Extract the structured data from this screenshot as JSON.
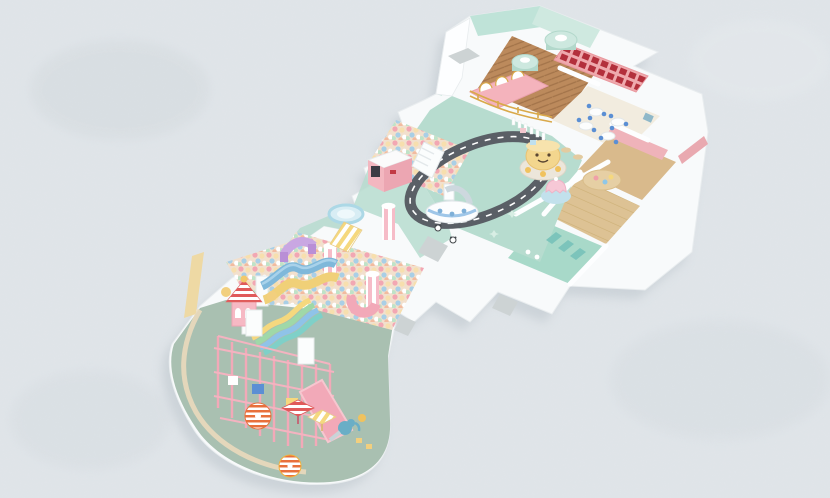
{
  "scene": {
    "subject": "isometric 3D render of a pastel children's indoor playground floor plan",
    "visible_text": ""
  },
  "palette": {
    "background": "#e0e5e9",
    "backgroundSpot": "#d5dbdf",
    "buildingShadow": "#b9c2c9",
    "wallWhite": "#f8fafb",
    "wallFace": "#fdfeff",
    "wallMint": "#bfe3d8",
    "wallMintLight": "#cfe9e0",
    "wallPink": "#efb3ba",
    "wallPinkDeep": "#e9a9b0",
    "wallCream": "#ead9bd",
    "wallYellow": "#eed9a4",
    "floorEntranceWood": "#bc8a5c",
    "floorParty": "#f2ecdf",
    "floorRoomWood": "#d9ba8c",
    "floorSlatWood": "#ddc294",
    "floorToilet": "#a8d9c9",
    "floorMint": "#b7dccf",
    "floorSage": "#a9c0b1",
    "ballPitBase": "#f2e0cd",
    "roadAsphalt": "#5a5f66",
    "roadLine": "#ffffff",
    "shelfPink": "#efa9ad",
    "shelfRed": "#b3303c",
    "counterPink": "#f4b3bc",
    "goldTrim": "#d9a94a",
    "tableMint": "#cde8df",
    "tableMintSide": "#b2d8cb",
    "chairBlue": "#5b8fd4",
    "tableWhite": "#fcfdfd",
    "stallTeal": "#7cc4bb",
    "carouselYellow": "#f3d68e",
    "carouselScallop": "#f7e3ad",
    "jellyfishPink": "#f6c8d6",
    "jellyfishMat": "#c2e1ec",
    "platformWood": "#e6cfa4",
    "houseFront": "#f3b7c0",
    "houseWindow": "#3c3c44",
    "boatWhite": "#fcfdfe",
    "boatBlue": "#9fc6e8",
    "trampolineBlue": "#d8edf4",
    "trampolineRing": "#acd8e6",
    "slideWaveBlue": "#7fb8da",
    "slideWaveYellow": "#f0d078",
    "tubePink": "#f2a9b8",
    "archPurple": "#c9a7e2",
    "towerPink": "#f6b9c4",
    "roofBandRed": "#e05a5a",
    "rainbowYellow": "#f5d87e",
    "rainbowGreen": "#9fd8a8",
    "rainbowBlue": "#8fc3e8",
    "rainbowTeal": "#7fd0c8",
    "structurePink": "#f2a9b8",
    "structurePinkLight": "#f7c6cf",
    "umbrellaOrange": "#e8703c",
    "umbrellaYellow": "#f2b13c",
    "elephantTeal": "#6aaec6",
    "matGray": "#cdd3d4",
    "fenceWhite": "#ffffff",
    "pandaDark": "#44484c",
    "starMint": "#d8eee4",
    "duckYellow": "#f0c25e"
  }
}
